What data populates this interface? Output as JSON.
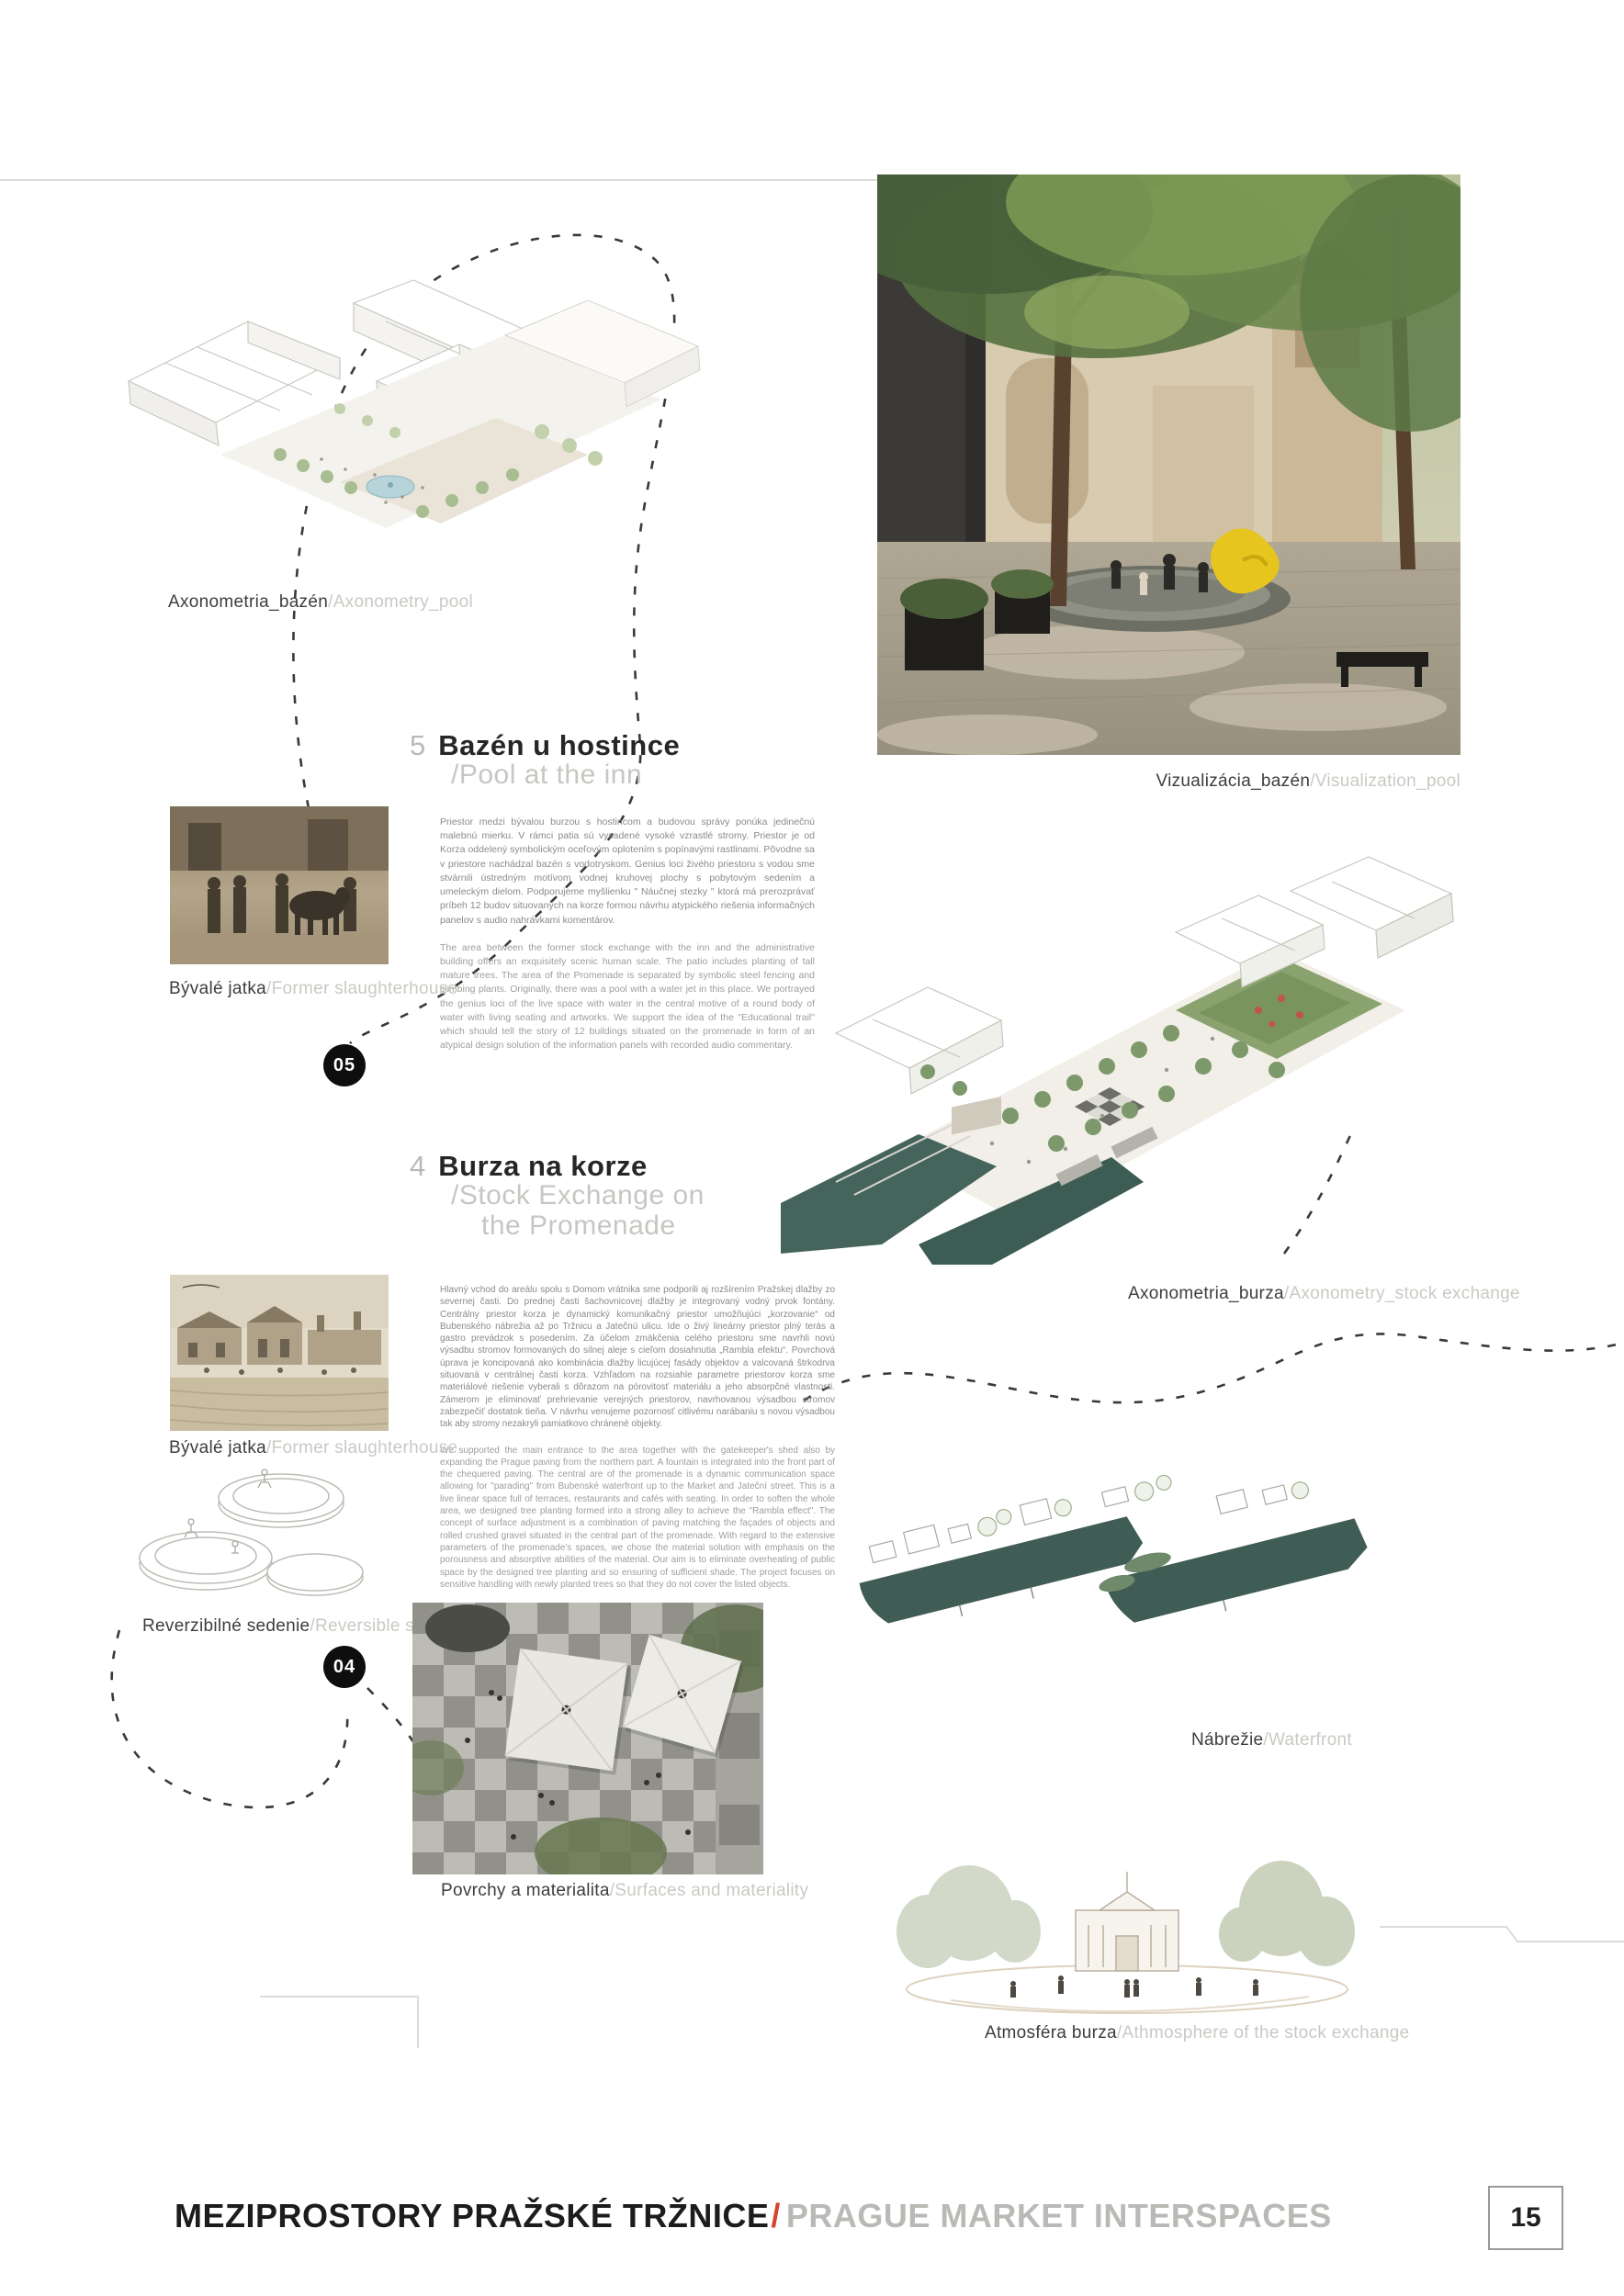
{
  "page": {
    "number": "15"
  },
  "footer": {
    "title_sk": "MEZIPROSTORY PRAŽSKÉ TRŽNICE",
    "separator": "/",
    "title_en": "PRAGUE MARKET INTERSPACES"
  },
  "colors": {
    "accent_red": "#d6452e",
    "ink": "#262626",
    "muted_gray": "#c6c6c2",
    "body_gray": "#8a8a87",
    "marker_black": "#0e0e0e",
    "water_teal": "#3f5d55"
  },
  "sections": {
    "pool": {
      "number": "5",
      "title_sk": "Bazén u hostince",
      "title_en": "/Pool at the inn",
      "marker": "05",
      "body_sk": "Priestor medzi bývalou burzou s hostincom a budovou správy ponúka jedinečnú malebnú mierku. V rámci patia sú vysadené vysoké vzrastlé stromy. Priestor je od Korza oddelený symbolickým oceľovým oplotením s popínavými rastlinami. Pôvodne sa v priestore nachádzal bazén s vodotryskom. Genius loci živého priestoru s vodou sme stvárnili ústredným motívom vodnej kruhovej plochy s pobytovým sedením a umeleckým dielom. Podporujeme myšlienku \" Náučnej stezky \" ktorá má prerozprávať príbeh 12 budov situovaných na korze formou návrhu atypického riešenia informačných panelov s audio nahrávkami komentárov.",
      "body_en": "The area between the former stock exchange with the inn and the administrative building offers an exquisitely scenic human scale. The patio includes planting of tall mature trees. The area of the Promenade is separated by symbolic steel fencing and climbing plants. Originally, there was a pool with a water jet in this place. We portrayed the genius loci of the live space with water in the central motive of a round body of water with living seating and artworks. We support the idea of the \"Educational trail\" which should tell the story of 12 buildings situated on the promenade in form of an atypical design solution of the information panels with recorded audio commentary."
    },
    "stock_exchange": {
      "number": "4",
      "title_sk": "Burza na korze",
      "title_en_line1": "/Stock Exchange on",
      "title_en_line2": "the Promenade",
      "marker": "04",
      "body_sk": "Hlavný vchod do areálu spolu s Domom vrátnika sme podporili aj rozšírením Pražskej dlažby zo severnej časti. Do prednej časti šachovnicovej dlažby je integrovaný vodný prvok fontány. Centrálny priestor korza je dynamický komunikačný priestor umožňujúci „korzovanie“ od Bubenského nábrežia až po Tržnicu a Jatečnú ulicu. Ide o živý lineárny priestor plný terás a gastro prevádzok s posedením. Za účelom zmäkčenia celého priestoru sme navrhli novú výsadbu stromov formovaných do silnej aleje s cieľom dosiahnutia „Rambla efektu“. Povrchová úprava je koncipovaná ako kombinácia dlažby licujúcej fasády objektov a valcovaná štrkodrva situovaná v centrálnej časti korza. Vzhľadom na rozsiahle parametre priestorov korza sme materiálové riešenie vyberali s dôrazom na pórovitosť materiálu a jeho absorpčné vlastnosti. Zámerom je eliminovať prehrievanie verejných priestorov, navrhovanou výsadbou stromov zabezpečiť dostatok tieňa. V návrhu venujeme pozornosť citlivému narábaniu s novou výsadbou tak aby stromy nezakryli pamiatkovo chránené objekty.",
      "body_en": "We supported the main entrance to the area together with the gatekeeper's shed also by expanding the Prague paving from the northern part. A fountain is integrated into the front part of the chequered paving. The central are of the promenade is a dynamic communication space allowing for \"parading\" from Bubenské waterfront up to the Market and Jateční street. This is a live linear space full of terraces, restaurants and cafés with seating. In order to soften the whole area, we designed tree planting formed into a strong alley to achieve the \"Rambla effect\". The concept of surface adjustment is a combination of paving matching the façades of objects and rolled crushed gravel situated in the central part of the promenade. With regard to the extensive parameters of the promenade's spaces, we chose the material solution with emphasis on the porousness and absorptive abilities of the material. Our aim is to eliminate overheating of public space by the designed tree planting and so ensuring of sufficient shade. The project focuses on sensitive handling with newly planted trees so that they do not cover the listed objects."
    }
  },
  "captions": {
    "axonometry_pool": {
      "sk": "Axonometria_bazén",
      "en": "/Axonometry_pool"
    },
    "visualization_pool": {
      "sk": "Vizualizácia_bazén",
      "en": "/Visualization_pool"
    },
    "former_slaughterhouse_1": {
      "sk": "Bývalé jatka",
      "en": "/Former slaughterhouse"
    },
    "former_slaughterhouse_2": {
      "sk": "Bývalé jatka",
      "en": "/Former slaughterhouse"
    },
    "axonometry_stock": {
      "sk": "Axonometria_burza",
      "en": "/Axonometry_stock exchange"
    },
    "reversible_seating": {
      "sk": "Reverzibilné sedenie",
      "en": "/Reversible seating"
    },
    "surfaces_materiality": {
      "sk": "Povrchy a materialita",
      "en": "/Surfaces and materiality"
    },
    "waterfront": {
      "sk": "Nábrežie",
      "en": "/Waterfront"
    },
    "atmosphere": {
      "sk": "Atmosféra burza",
      "en": "/Athmosphere of the stock exchange"
    }
  }
}
